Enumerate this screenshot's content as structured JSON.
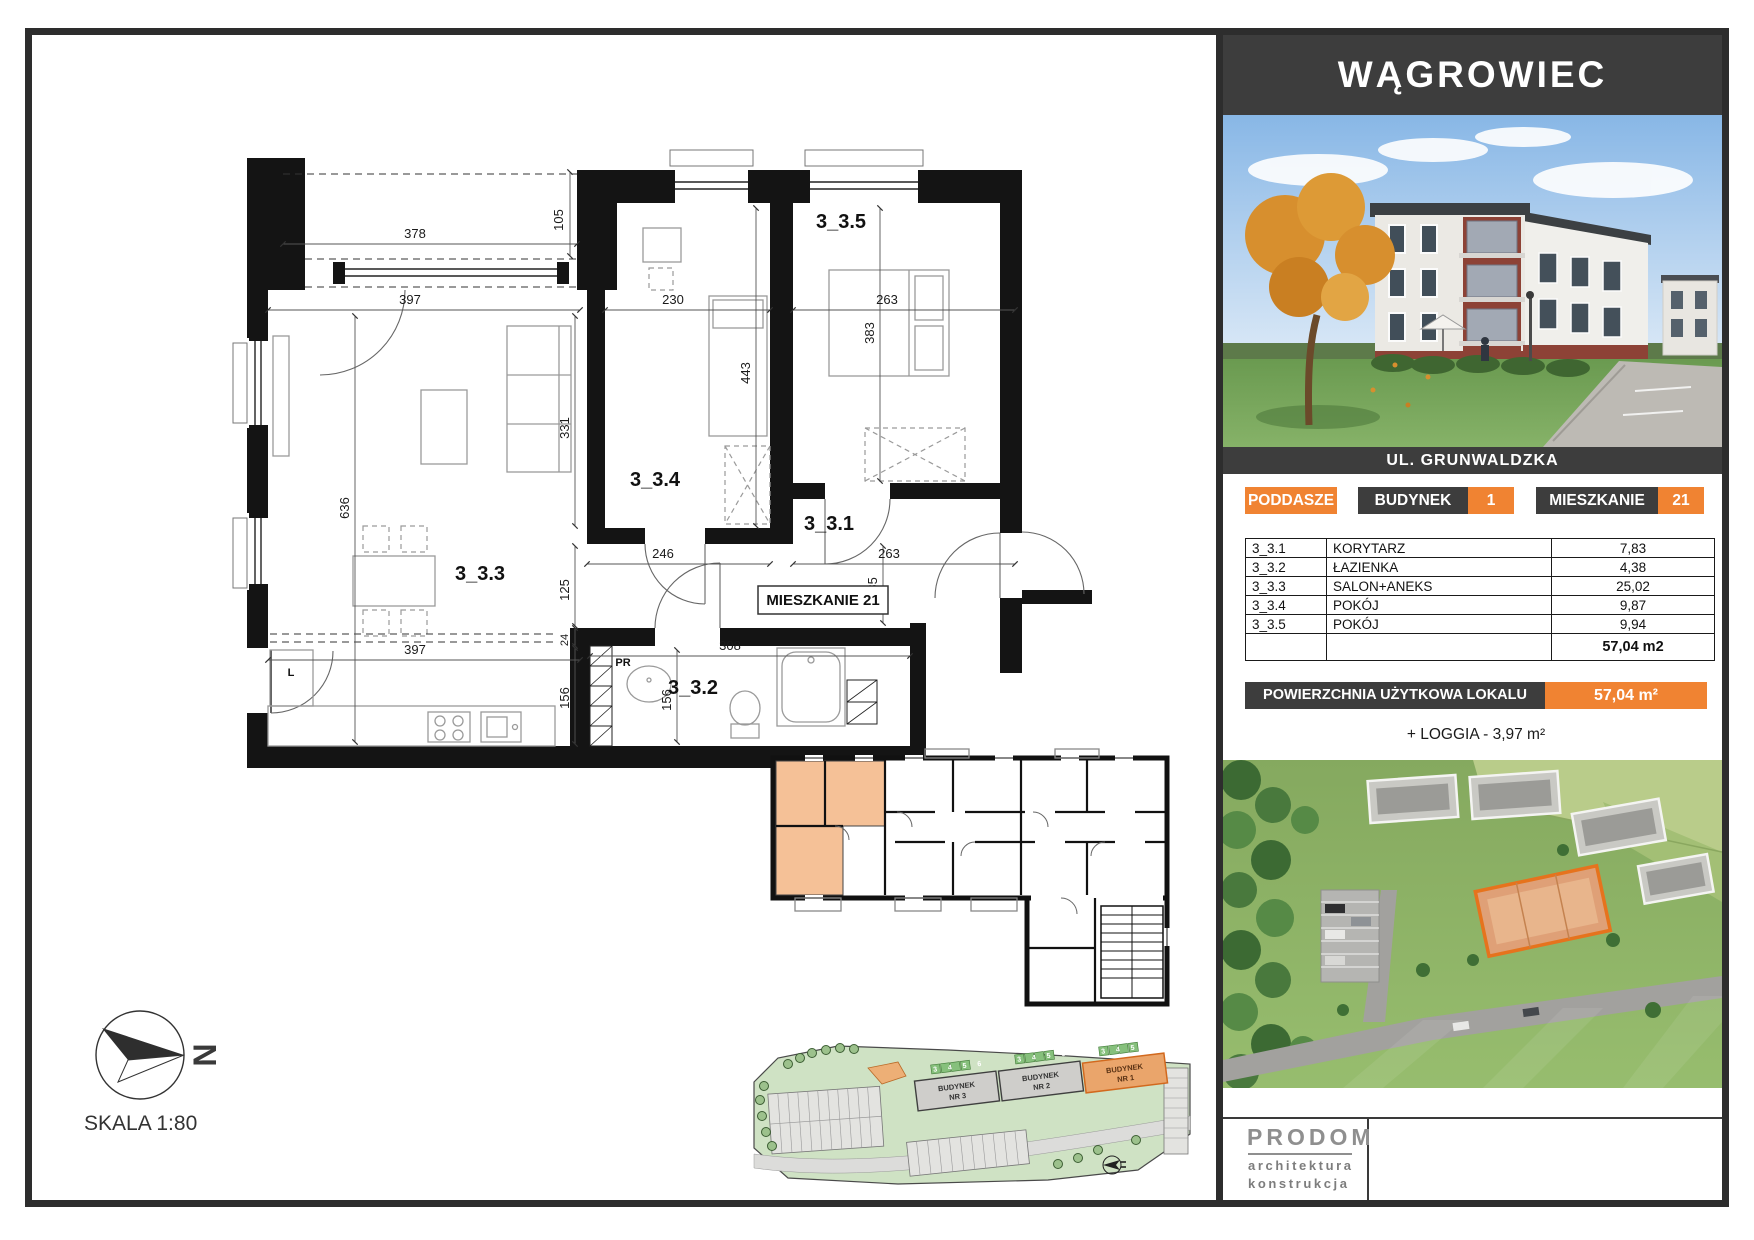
{
  "panel": {
    "city": "WĄGROWIEC",
    "street": "UL. GRUNWALDZKA",
    "floor_badge": "PODDASZE",
    "building_label": "BUDYNEK",
    "building_number": "1",
    "apartment_label": "MIESZKANIE",
    "apartment_number": "21",
    "area_table": {
      "rows": [
        {
          "code": "3_3.1",
          "name": "KORYTARZ",
          "area": "7,83"
        },
        {
          "code": "3_3.2",
          "name": "ŁAZIENKA",
          "area": "4,38"
        },
        {
          "code": "3_3.3",
          "name": "SALON+ANEKS",
          "area": "25,02"
        },
        {
          "code": "3_3.4",
          "name": "POKÓJ",
          "area": "9,87"
        },
        {
          "code": "3_3.5",
          "name": "POKÓJ",
          "area": "9,94"
        }
      ],
      "total": "57,04 m2"
    },
    "area_bar_label": "POWIERZCHNIA UŻYTKOWA LOKALU",
    "area_bar_value": "57,04 m²",
    "loggia_note": "+ LOGGIA - 3,97 m²",
    "logo": {
      "name": "PRODOM",
      "sub1": "architektura",
      "sub2": "konstrukcja"
    }
  },
  "plan": {
    "scale_label": "SKALA 1:80",
    "north_letter": "N",
    "apartment_box": "MIESZKANIE 21",
    "room_labels": [
      "3_3.1",
      "3_3.2",
      "3_3.3",
      "3_3.4",
      "3_3.5"
    ],
    "fixture_labels": {
      "fridge": "L",
      "washer": "PR"
    },
    "dims": [
      "378",
      "105",
      "397",
      "230",
      "263",
      "331",
      "636",
      "443",
      "383",
      "246",
      "263",
      "125",
      "24",
      "185",
      "397",
      "156",
      "156",
      "308"
    ]
  },
  "site_plan": {
    "buildings": [
      {
        "line1": "BUDYNEK",
        "line2": "NR 3"
      },
      {
        "line1": "BUDYNEK",
        "line2": "NR 2"
      },
      {
        "line1": "BUDYNEK",
        "line2": "NR 1"
      }
    ],
    "unit_numbers": "3 4 5 6"
  },
  "colors": {
    "accent": "#F08332",
    "dark": "#3d3d3d"
  }
}
